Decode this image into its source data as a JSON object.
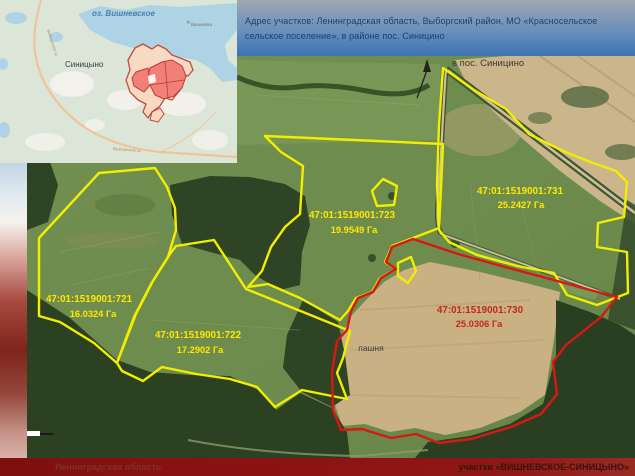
{
  "header": {
    "address_line": "Адрес участков: Ленинградская область, Выборгский район,  МО «Красносельское сельское поселение», в районе пос. Синицино"
  },
  "inset_map": {
    "lake_label": "оз. Вишневское",
    "settlement_label": "Синицыно",
    "village_label": "Вишневка",
    "road_label": "Выборгское ш."
  },
  "satellite_map": {
    "direction_label": "в пос. Синицино",
    "land_use_label": "пашня",
    "parcels": [
      {
        "cadastral_number": "47:01:1519001:721",
        "area_label": "16.0324 Га",
        "outline_color": "#f2ee00"
      },
      {
        "cadastral_number": "47:01:1519001:722",
        "area_label": "17.2902 Га",
        "outline_color": "#f2ee00"
      },
      {
        "cadastral_number": "47:01:1519001:723",
        "area_label": "19.9549 Га",
        "outline_color": "#f2ee00"
      },
      {
        "cadastral_number": "47:01:1519001:731",
        "area_label": "25.2427 Га",
        "outline_color": "#f2ee00"
      },
      {
        "cadastral_number": "47:01:1519001:730",
        "area_label": "25.0306 Га",
        "outline_color": "#d81812"
      }
    ]
  },
  "footer": {
    "region_label": "Ленинградская область",
    "project_label": "участки «ВИШНЕВСКОЕ-СИНИЦЫНО»"
  },
  "colors": {
    "parcel_yellow": "#f2ee00",
    "parcel_red": "#d81812",
    "label_yellow": "#ffe800",
    "label_red": "#c5271e",
    "footer_bg": "#8c1212",
    "water": "#aed3e4",
    "header_text": "#1d3f77"
  }
}
